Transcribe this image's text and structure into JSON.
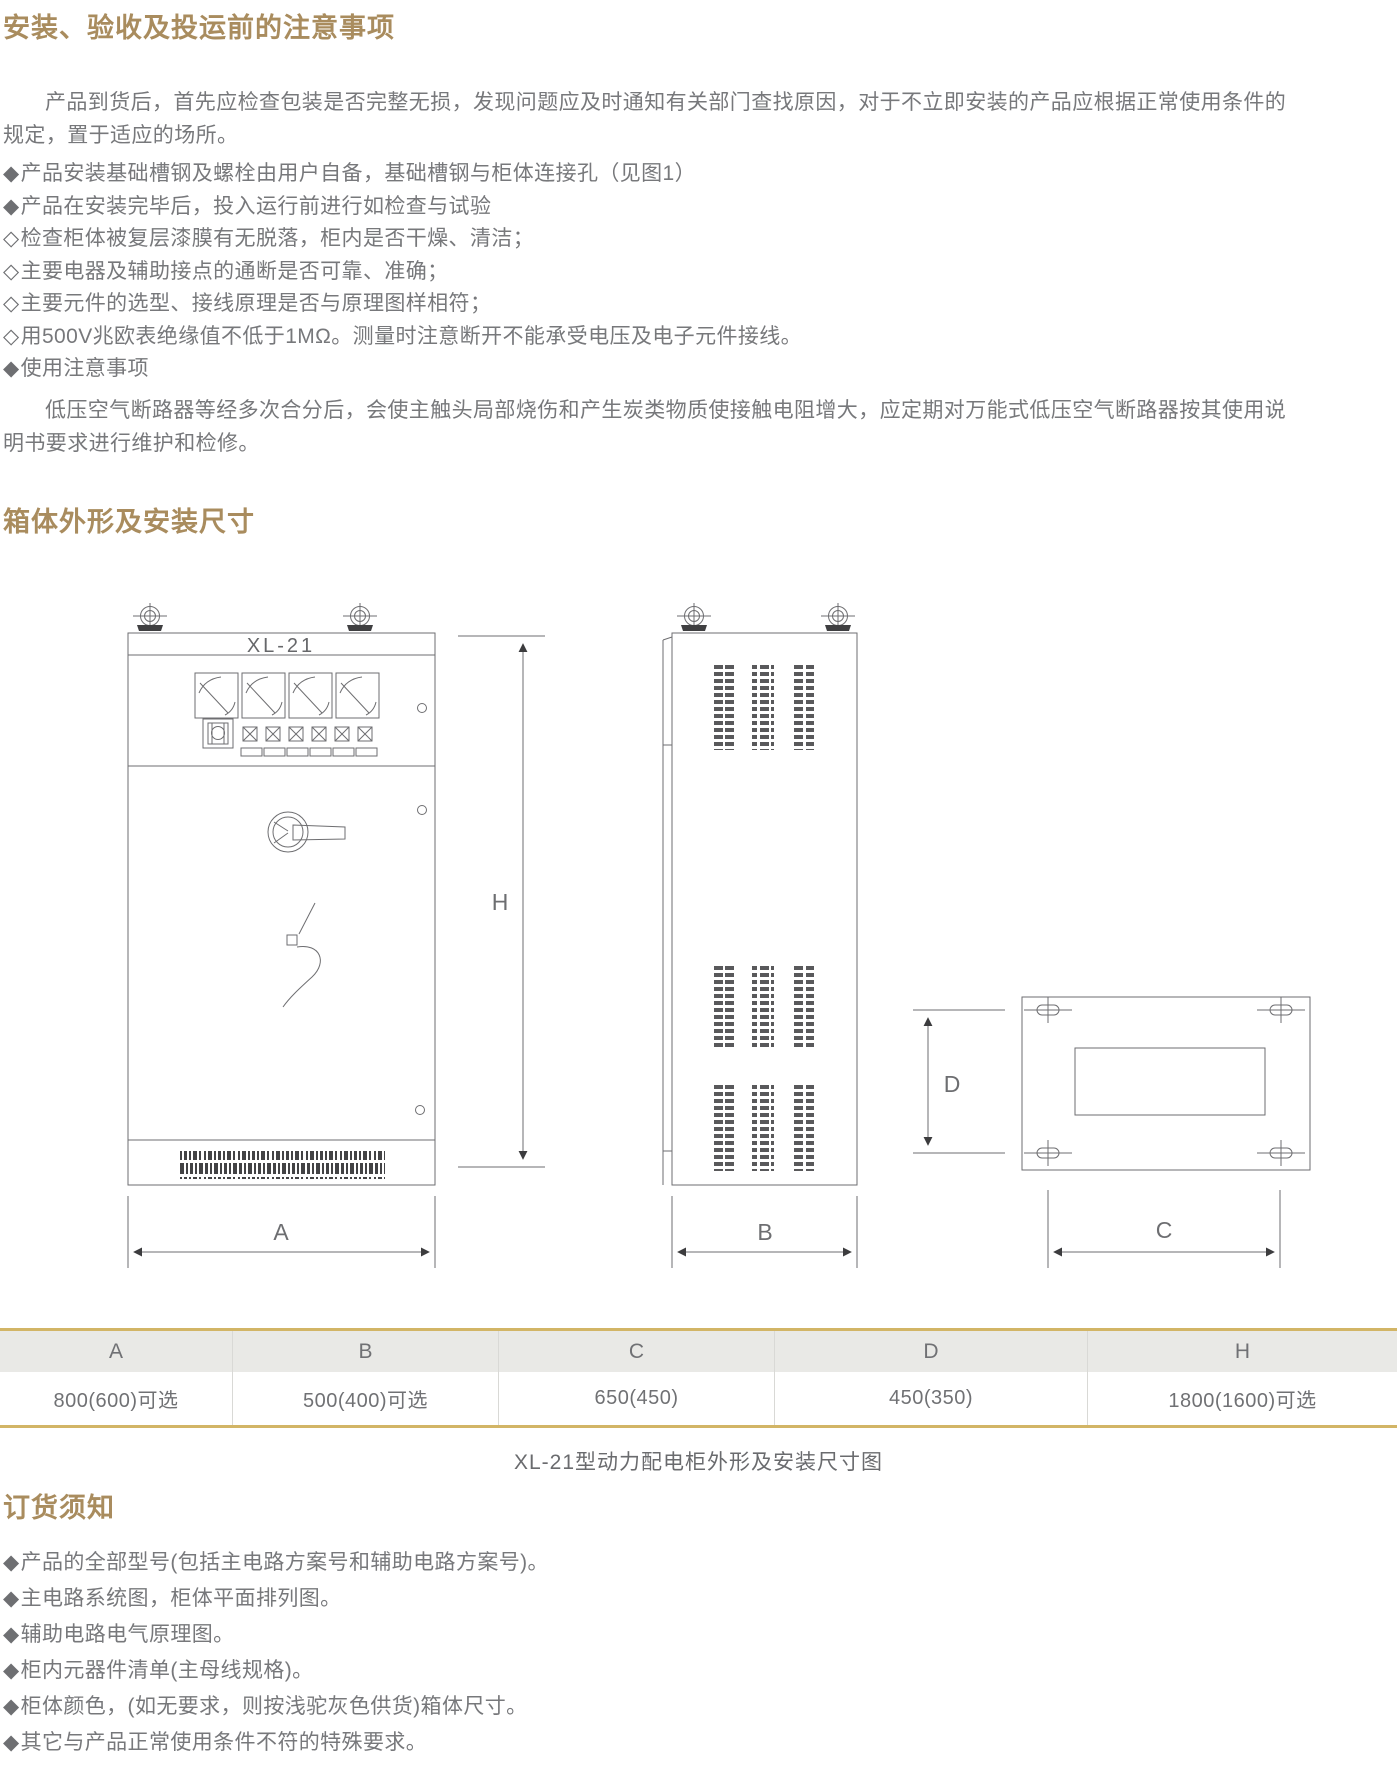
{
  "section1": {
    "title": "安装、验收及投运前的注意事项",
    "paragraph": "产品到货后，首先应检查包装是否完整无损，发现问题应及时通知有关部门查找原因，对于不立即安装的产品应根据正常使用条件的规定，置于适应的场所。",
    "bullets": [
      {
        "marker": "◆",
        "text": "产品安装基础槽钢及螺栓由用户自备，基础槽钢与柜体连接孔（见图1）"
      },
      {
        "marker": "◆",
        "text": "产品在安装完毕后，投入运行前进行如检查与试验"
      },
      {
        "marker": "◇",
        "text": "检查柜体被复层漆膜有无脱落，柜内是否干燥、清洁；"
      },
      {
        "marker": "◇",
        "text": "主要电器及辅助接点的通断是否可靠、准确；"
      },
      {
        "marker": "◇",
        "text": "主要元件的选型、接线原理是否与原理图样相符；"
      },
      {
        "marker": "◇",
        "text": "用500V兆欧表绝缘值不低于1MΩ。测量时注意断开不能承受电压及电子元件接线。"
      },
      {
        "marker": "◆",
        "text": "使用注意事项"
      }
    ],
    "closing_paragraph": "低压空气断路器等经多次合分后，会使主触头局部烧伤和产生炭类物质使接触电阻增大，应定期对万能式低压空气断路器按其使用说明书要求进行维护和检修。"
  },
  "section2": {
    "title": "箱体外形及安装尺寸",
    "drawing": {
      "model_label": "XL-21",
      "dims": {
        "h": "H",
        "a": "A",
        "b": "B",
        "c": "C",
        "d": "D"
      }
    },
    "table": {
      "headers": [
        "A",
        "B",
        "C",
        "D",
        "H"
      ],
      "values": [
        "800(600)可选",
        "500(400)可选",
        "650(450)",
        "450(350)",
        "1800(1600)可选"
      ]
    },
    "caption": "XL-21型动力配电柜外形及安装尺寸图"
  },
  "section3": {
    "title": "订货须知",
    "bullets": [
      {
        "marker": "◆",
        "text": "产品的全部型号(包括主电路方案号和辅助电路方案号)。"
      },
      {
        "marker": "◆",
        "text": "主电路系统图，柜体平面排列图。"
      },
      {
        "marker": "◆",
        "text": "辅助电路电气原理图。"
      },
      {
        "marker": "◆",
        "text": "柜内元器件清单(主母线规格)。"
      },
      {
        "marker": "◆",
        "text": "柜体颜色，(如无要求，则按浅驼灰色供货)箱体尺寸。"
      },
      {
        "marker": "◆",
        "text": "其它与产品正常使用条件不符的特殊要求。"
      }
    ]
  },
  "colors": {
    "heading": "#a98c5e",
    "body_text": "#77787b",
    "gold_border": "#d2b566",
    "table_header_bg": "#e9e9e6",
    "drawing_line": "#6e6e71"
  }
}
